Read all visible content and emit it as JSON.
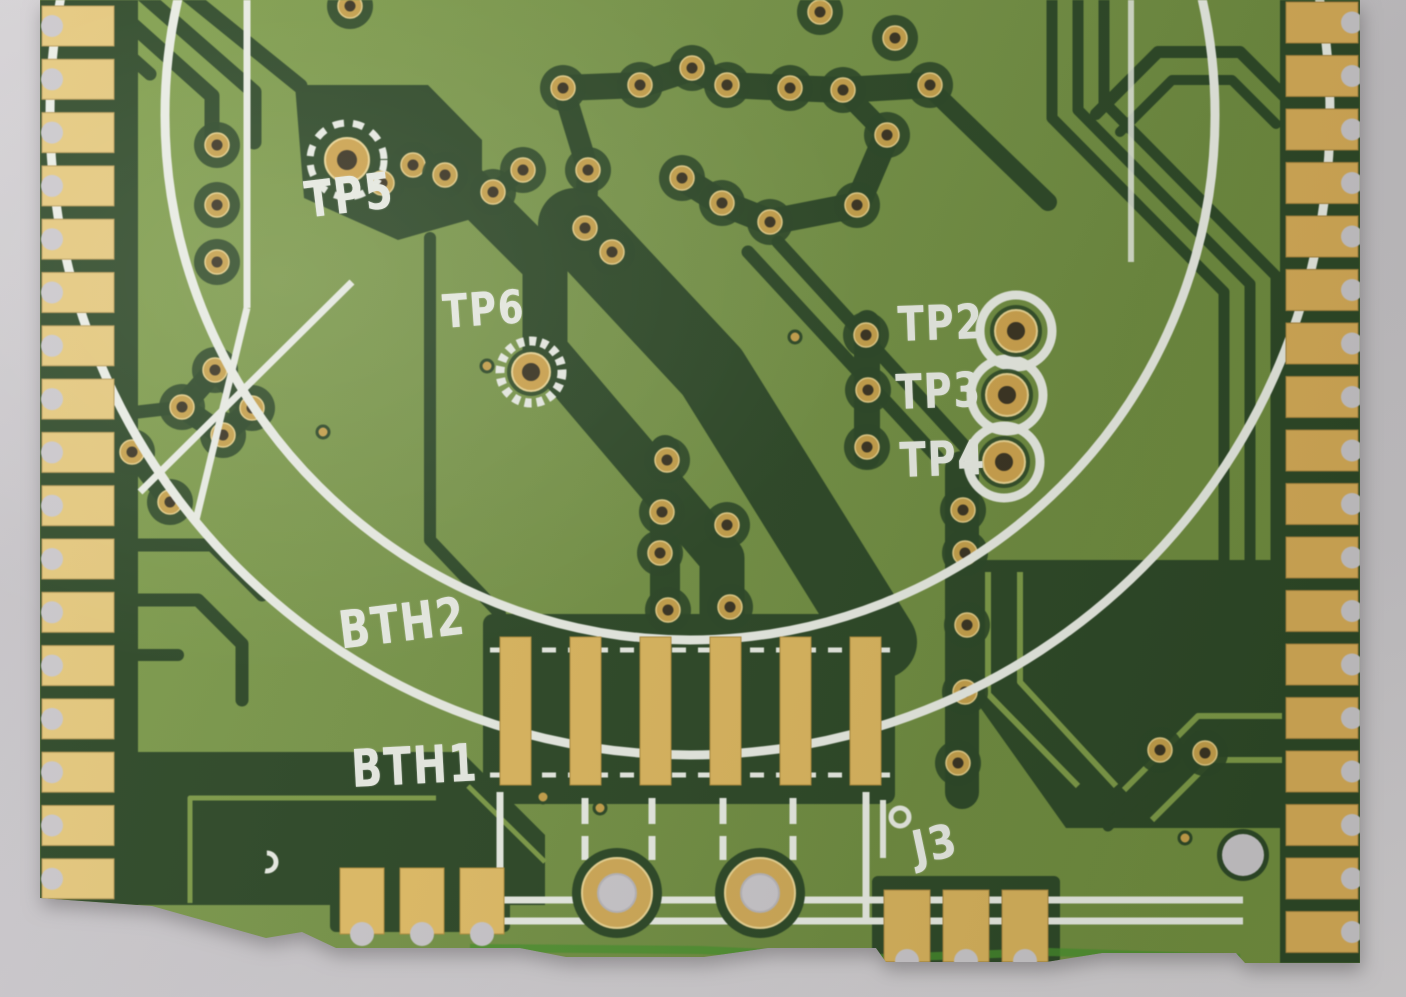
{
  "photo": {
    "subject": "close-up photograph of a green printed circuit board corner with gold castellated edge pads",
    "background_surface": "light gray desk"
  },
  "colors": {
    "background_gray": "#cbc8cc",
    "soldermask_olive": "#79964a",
    "copper_trace_dark": "#2d4827",
    "gold_pad": "#d9b35e",
    "silkscreen_white": "#eaede5",
    "board_edge_green": "#48922e"
  },
  "silkscreen_labels": {
    "tp5": "TP5",
    "tp6": "TP6",
    "tp2": "TP2",
    "tp3": "TP3",
    "tp4": "TP4",
    "bth2": "BTH2",
    "bth1": "BTH1",
    "j3": "J3"
  },
  "structure": {
    "left_edge_pad_count": 17,
    "right_edge_pad_count": 18,
    "connector_pad_count": 6,
    "bottom_left_pad_count": 3,
    "bottom_right_pad_count": 3,
    "mounting_hole_count": 2,
    "test_point_labels": [
      "TP2",
      "TP3",
      "TP4",
      "TP5",
      "TP6"
    ]
  }
}
